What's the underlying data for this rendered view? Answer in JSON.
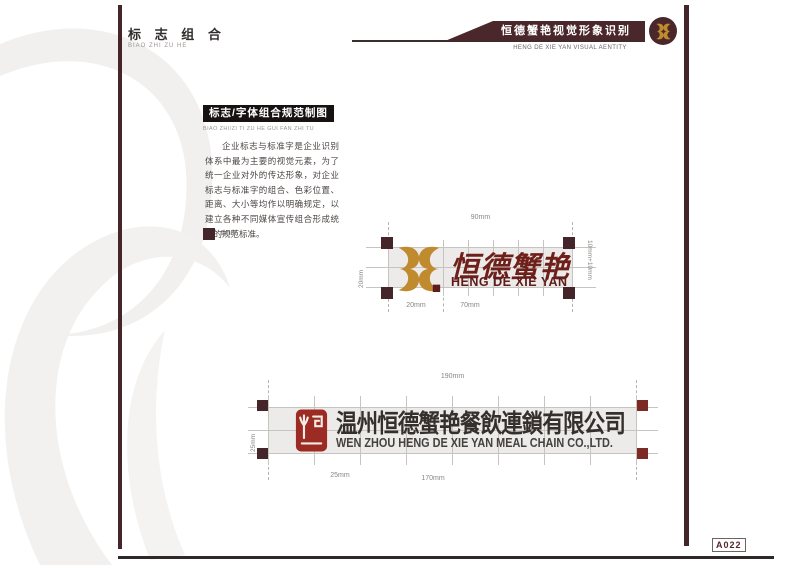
{
  "header": {
    "section_title_cn": "标 志 组 合",
    "section_title_pinyin": "BIAO ZHI ZU HE",
    "banner_title_cn": "恒德蟹艳视觉形象识别",
    "banner_subtitle_en": "HENG DE XIE YAN VISUAL AENTITY",
    "badge_icon": "hengde-crab-monogram-icon"
  },
  "section": {
    "heading_cn": "标志/字体组合规范制图",
    "heading_pinyin": "BIAO ZHI/ZI TI ZU HE GUI FAN ZHI TU",
    "body_cn": "企业标志与标准字是企业识别体系中最为主要的视觉元素，为了统一企业对外的传达形象，对企业标志与标准字的组合、色彩位置、距离、大小等均作以明确规定，以建立各种不同媒体宣传组合形成统一的规范标准。",
    "legend_label": "5mm"
  },
  "logo_small": {
    "monogram_icon": "hengde-crab-monogram-icon",
    "wordmark_cn": "恒德蟹艳",
    "wordmark_en": "HENG DE XIE YAN",
    "dims": {
      "top": "90mm",
      "left": "20mm",
      "right": "10mm+10mm",
      "bottom_left": "20mm",
      "bottom_right": "70mm"
    }
  },
  "logo_large": {
    "seal_icon": "hengde-seal-stamp-icon",
    "name_cn": "温州恒德蟹艳餐飲連鎖有限公司",
    "name_en": "WEN ZHOU HENG DE XIE YAN MEAL CHAIN CO.,LTD.",
    "dims": {
      "top": "190mm",
      "left": "25mm",
      "bottom_left": "25mm",
      "bottom_center": "170mm"
    }
  },
  "footer": {
    "page_code": "A022"
  },
  "colors": {
    "maroon": "#4a272b",
    "gold": "#c08a2e",
    "seal_red": "#9c2b24",
    "calligraphy_red": "#6e1f1a",
    "company_text": "#35302d",
    "band_gray": "#ecebe9"
  }
}
